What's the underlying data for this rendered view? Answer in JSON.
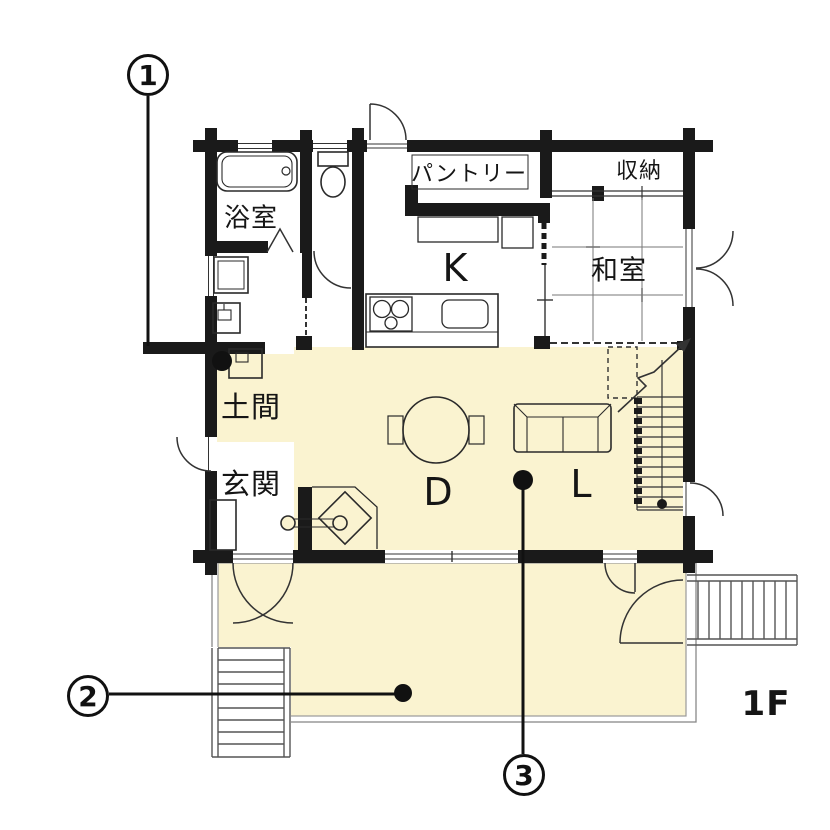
{
  "title": "1F floor plan",
  "floor_label": "1F",
  "rooms": {
    "bathroom": "浴室",
    "pantry": "パントリー",
    "storage": "収納",
    "kitchen": "K",
    "japanese_room": "和室",
    "doma": "土間",
    "entrance": "玄関",
    "dining": "D",
    "living": "L"
  },
  "callouts": [
    {
      "number": "1"
    },
    {
      "number": "2"
    },
    {
      "number": "3"
    }
  ],
  "fixtures": [
    "bathtub",
    "toilet",
    "washing-machine",
    "washbasin",
    "doma-sink",
    "wood-stove",
    "kitchen-counter",
    "cooktop",
    "kitchen-sink",
    "refrigerator",
    "cupboard",
    "dining-table",
    "chairs",
    "sofa",
    "staircase",
    "shoe-cabinet",
    "deck",
    "exterior-stairs"
  ],
  "colors": {
    "highlight": "#faf3d0",
    "wall": "#1a1a1a",
    "line": "#333333",
    "grid": "#777777",
    "deck_border": "#888888"
  }
}
